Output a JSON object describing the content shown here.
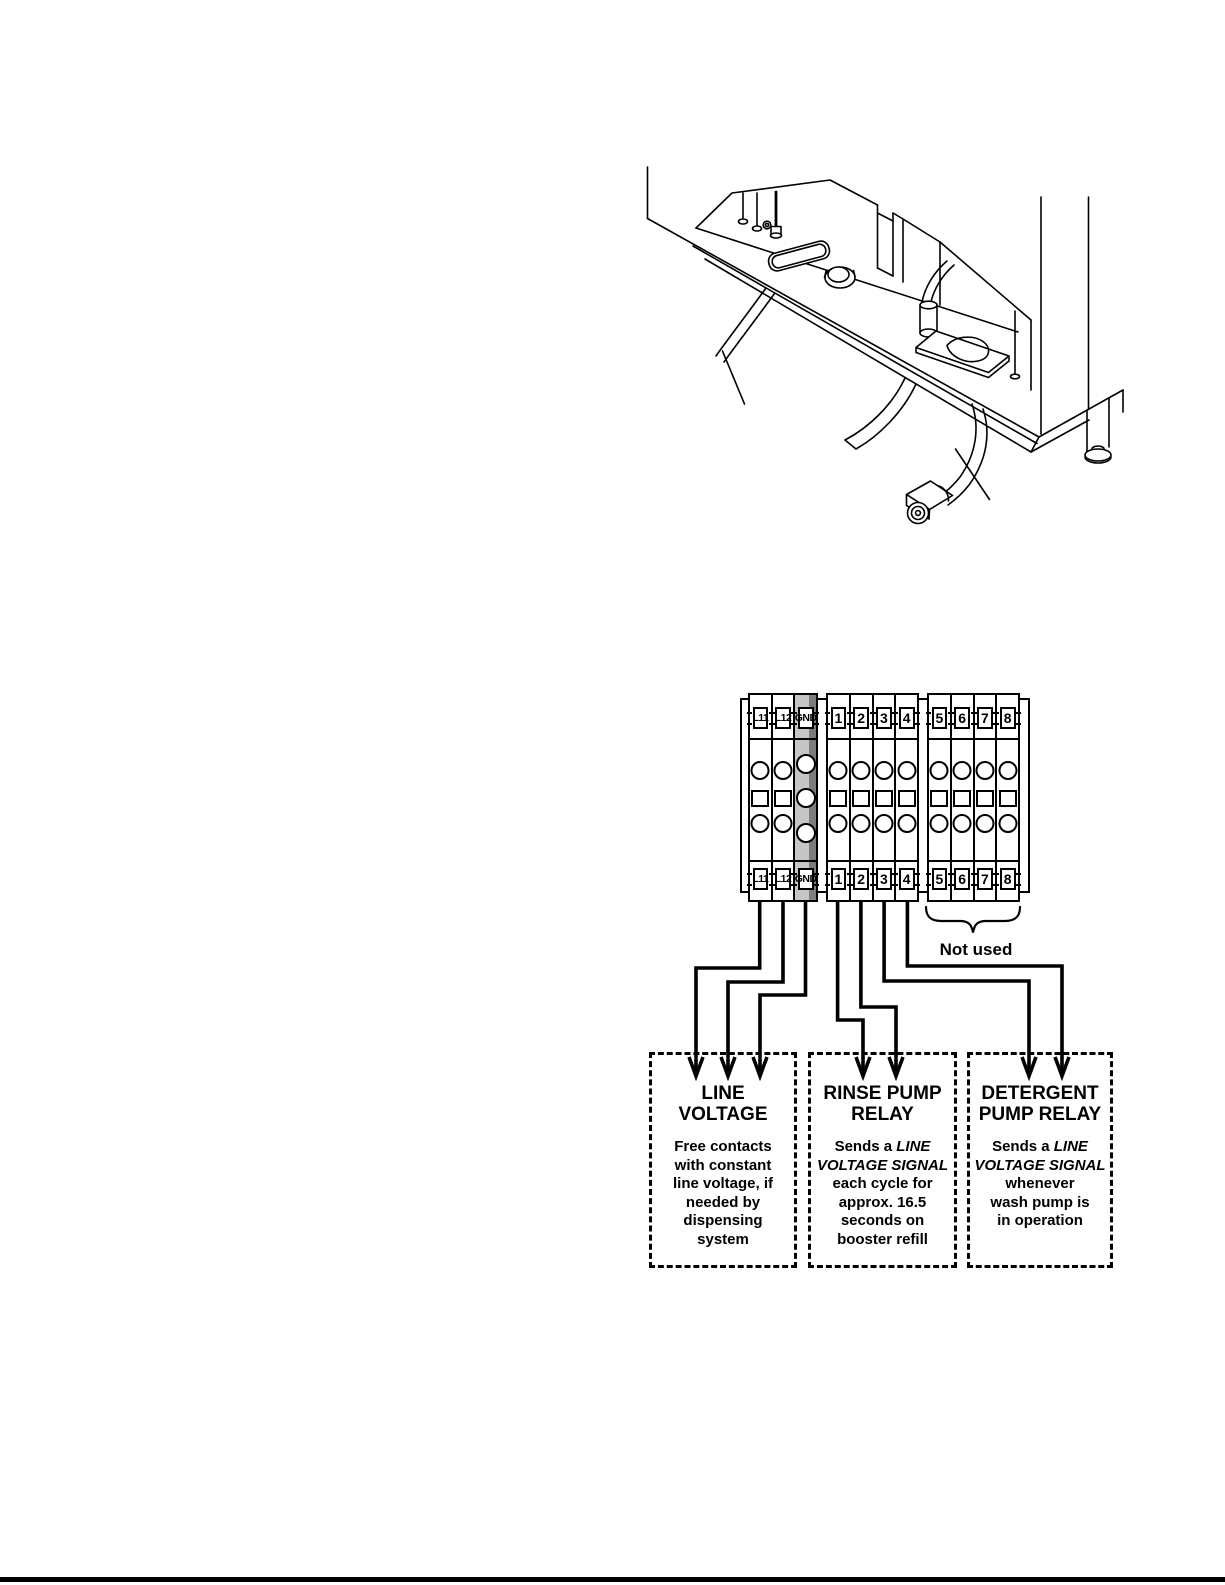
{
  "page": {
    "background": "#ffffff",
    "footer_rule_color": "#000000"
  },
  "illustration": {
    "name": "dish-machine-underside-line-art"
  },
  "terminal_block": {
    "groups": [
      {
        "labels": [
          "L11",
          "L12",
          "GND"
        ]
      },
      {
        "labels": [
          "1",
          "2",
          "3",
          "4"
        ]
      },
      {
        "labels": [
          "5",
          "6",
          "7",
          "8"
        ]
      }
    ],
    "gnd_shade_light": "#c6c6c6",
    "gnd_shade_dark": "#7d7d7d",
    "not_used_label": "Not used"
  },
  "callouts": [
    {
      "title": "LINE\nVOLTAGE",
      "body_parts": [
        {
          "text": "Free contacts\nwith constant\nline voltage, if\nneeded by\ndispensing\nsystem",
          "italic": false
        }
      ]
    },
    {
      "title": "RINSE PUMP\nRELAY",
      "body_parts": [
        {
          "text": "Sends a ",
          "italic": false
        },
        {
          "text": "LINE\nVOLTAGE SIGNAL",
          "italic": true
        },
        {
          "text": "\neach cycle for\napprox. 16.5\nseconds on\nbooster refill",
          "italic": false
        }
      ]
    },
    {
      "title": "DETERGENT\nPUMP RELAY",
      "body_parts": [
        {
          "text": "Sends a ",
          "italic": false
        },
        {
          "text": "LINE\nVOLTAGE SIGNAL",
          "italic": true
        },
        {
          "text": "\nwhenever\nwash pump is\nin operation",
          "italic": false
        }
      ]
    }
  ]
}
